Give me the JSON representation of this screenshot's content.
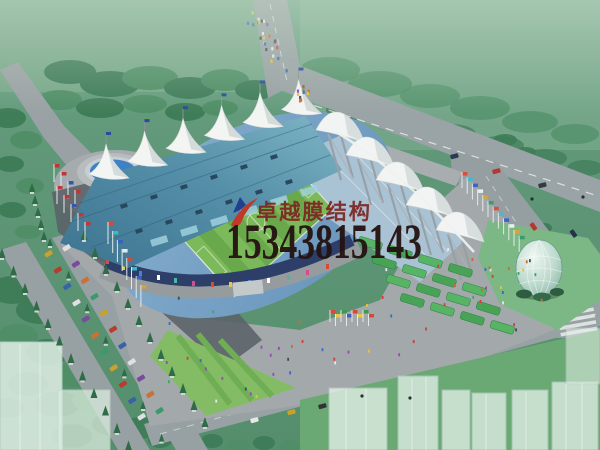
{
  "watermark": {
    "company_name": "卓越膜结构",
    "phone_number": "15343815143",
    "logo_icon": "red-swoosh-logo-icon",
    "company_color": "#7d2420",
    "phone_color": "#241210",
    "logo_red": "#c0392b",
    "logo_blue": "#1f3f8f"
  },
  "scene": {
    "description": "Aerial perspective rendering of a stadium with white tensile membrane roofs, teal grandstand roof, striped green pitch, plazas with crowds and flags, tree-lined avenues, roads with cars, a glass dome pavilion and semi-transparent surrounding buildings",
    "palette": {
      "haze_green": "#68a083",
      "tree_green": "#3f7c58",
      "road_gray": "#99a1a4",
      "plaza_gray": "#a3a8ab",
      "shadow_gray": "#5a6268",
      "roof_teal": "#4e87a0",
      "membrane_white": "#f3f5f3",
      "pitch_green": "#6aa84c",
      "water_blue": "#4080c4",
      "dome_glass": "#cfe6dc",
      "facade_navy": "#2d3e68"
    }
  }
}
